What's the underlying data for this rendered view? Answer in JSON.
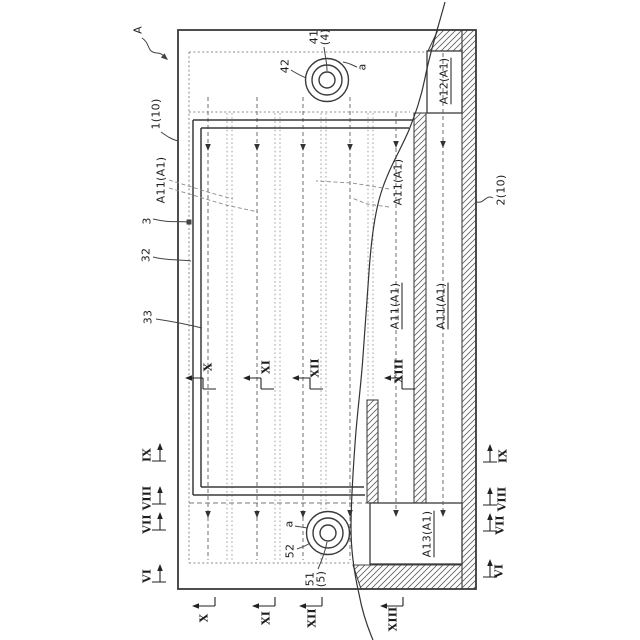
{
  "figure": {
    "labels": {
      "assembly": "A",
      "member1": "1(10)",
      "member2": "2(10)",
      "frame": "3",
      "frame_outer_line": "32",
      "frame_inner_line": "33",
      "adhesive_row_left": "A11(A1)",
      "adhesive_row_mid": "A11(A1)",
      "adhesive_col_1": "A11(A1)",
      "adhesive_col_2": "A11(A1)",
      "adhesive_top": "A12(A1)",
      "adhesive_bottom": "A13(A1)",
      "hole_top": "41",
      "hole_top_group": "(4)",
      "hole_top_ring": "42",
      "hole_top_point": "a",
      "hole_bottom": "51",
      "hole_bottom_group": "(5)",
      "hole_bottom_ring": "52",
      "hole_bottom_point": "a"
    },
    "section_markers": {
      "interior": [
        "X",
        "XI",
        "XII",
        "XIII"
      ],
      "bottom": [
        "X",
        "XI",
        "XII",
        "XIII"
      ],
      "left": [
        "IX",
        "VIII",
        "VII",
        "VI"
      ],
      "right": [
        "IX",
        "VIII",
        "VII",
        "VI"
      ]
    }
  }
}
